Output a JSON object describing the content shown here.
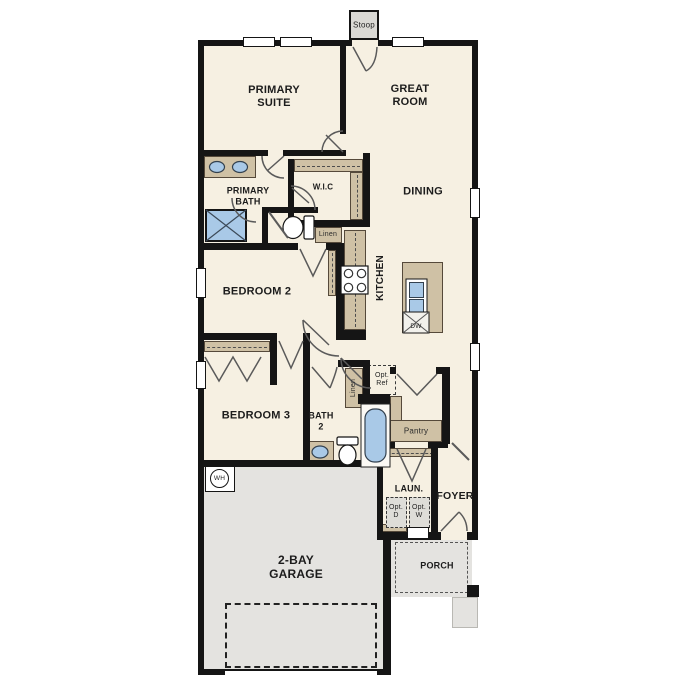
{
  "plan": {
    "labels": {
      "stoop": "Stoop",
      "primary_suite": "PRIMARY\nSUITE",
      "great_room": "GREAT\nROOM",
      "primary_bath": "PRIMARY\nBATH",
      "wic": "W.I.C",
      "linen_primary": "Linen",
      "dining": "DINING",
      "kitchen": "KITCHEN",
      "dishwasher": "DW",
      "bedroom_2": "BEDROOM 2",
      "bedroom_3": "BEDROOM 3",
      "bath_2": "BATH\n2",
      "linen_bath": "Linen",
      "optional_refrigerator": "Opt.\nRef",
      "pantry": "Pantry",
      "laundry": "LAUN.",
      "optional_dryer": "Opt.\nD",
      "optional_washer": "Opt.\nW",
      "foyer": "FOYER",
      "water_heater": "WH",
      "garage": "2-BAY\nGARAGE",
      "porch": "PORCH"
    },
    "colors": {
      "floor_interior": "#f6f0e2",
      "floor_garage": "#e4e3e0",
      "floor_stoop": "#dad9d5",
      "wall": "#151515",
      "cabinet": "#cfc1a5",
      "fixture_blue": "#a9c9e7",
      "door_stroke": "#5a5a5a"
    }
  }
}
